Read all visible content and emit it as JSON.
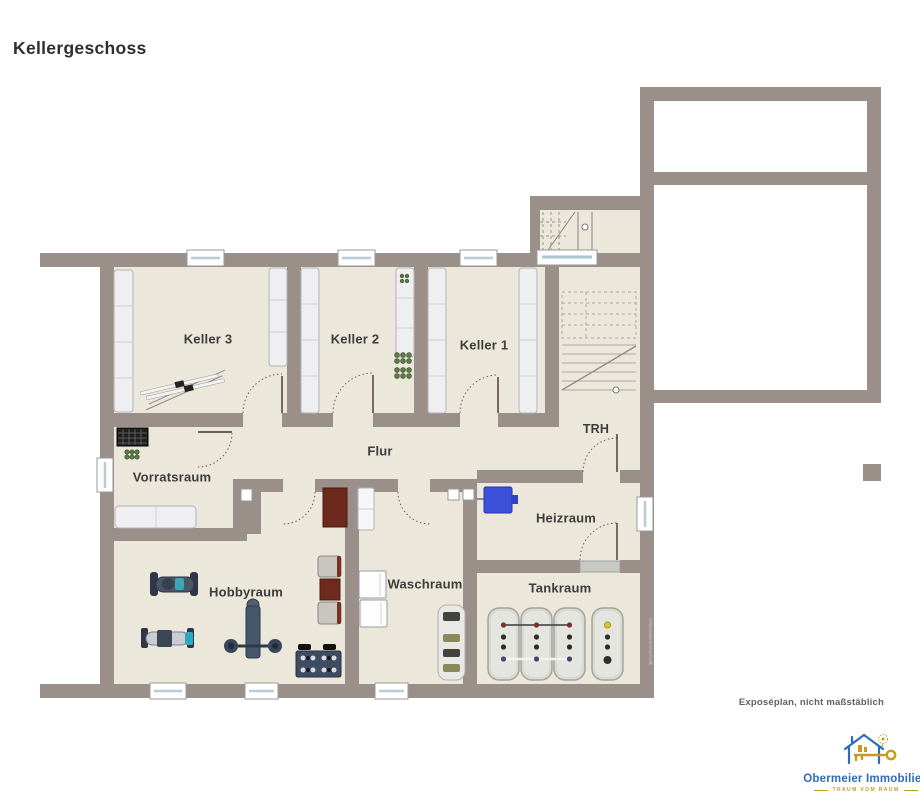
{
  "title": "Kellergeschoss",
  "rooms": {
    "keller3": "Keller 3",
    "keller2": "Keller 2",
    "keller1": "Keller 1",
    "trh": "TRH",
    "flur": "Flur",
    "vorratsraum": "Vorratsraum",
    "heizraum": "Heizraum",
    "hobbyraum": "Hobbyraum",
    "waschraum": "Waschraum",
    "tankraum": "Tankraum"
  },
  "footer": {
    "disclaimer": "Exposéplan, nicht maßstäblich",
    "watermark": "©IllustrationImmoGrafik"
  },
  "logo": {
    "company": "Obermeier Immobilien",
    "tagline": "TRAUM VOM RAUM"
  },
  "colors": {
    "wall": "#9b9089",
    "floor": "#ece7db",
    "door_leaf_brown": "#6d2a1c",
    "boiler_blue": "#3b4fd8",
    "wine_green": "#5e7a46",
    "logo_blue": "#2e6cb5",
    "logo_gold": "#c89a1e"
  }
}
